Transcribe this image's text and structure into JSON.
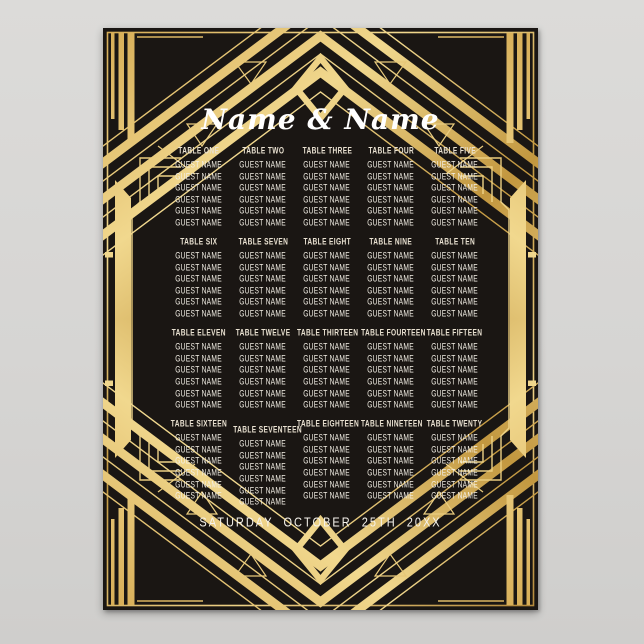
{
  "poster": {
    "title": "Name & Name",
    "date_line": "SATURDAY OCTOBER 25TH 20XX",
    "style": "art-deco-gatsby-seating-chart",
    "theme_colors": {
      "poster_black": "#1a1613",
      "gold_light": "#f1d88e",
      "gold_mid": "#d6ac55",
      "gold_deep": "#b3883a",
      "header_text": "#e9e1d1",
      "guest_text": "#f3efe5",
      "title_text": "#ffffff",
      "backdrop_gray": "#d6d5d3"
    },
    "guests_per_table": 6,
    "rows": [
      {
        "tables": [
          {
            "label": "TABLE ONE",
            "guests": [
              "GUEST NAME",
              "GUEST NAME",
              "GUEST NAME",
              "GUEST NAME",
              "GUEST NAME",
              "GUEST NAME"
            ]
          },
          {
            "label": "TABLE TWO",
            "guests": [
              "GUEST NAME",
              "GUEST NAME",
              "GUEST NAME",
              "GUEST NAME",
              "GUEST NAME",
              "GUEST NAME"
            ]
          },
          {
            "label": "TABLE THREE",
            "guests": [
              "GUEST NAME",
              "GUEST NAME",
              "GUEST NAME",
              "GUEST NAME",
              "GUEST NAME",
              "GUEST NAME"
            ]
          },
          {
            "label": "TABLE FOUR",
            "guests": [
              "GUEST NAME",
              "GUEST NAME",
              "GUEST NAME",
              "GUEST NAME",
              "GUEST NAME",
              "GUEST NAME"
            ]
          },
          {
            "label": "TABLE FIVE",
            "guests": [
              "GUEST NAME",
              "GUEST NAME",
              "GUEST NAME",
              "GUEST NAME",
              "GUEST NAME",
              "GUEST NAME"
            ]
          }
        ]
      },
      {
        "tables": [
          {
            "label": "TABLE SIX",
            "guests": [
              "GUEST NAME",
              "GUEST NAME",
              "GUEST NAME",
              "GUEST NAME",
              "GUEST NAME",
              "GUEST NAME"
            ]
          },
          {
            "label": "TABLE SEVEN",
            "guests": [
              "GUEST NAME",
              "GUEST NAME",
              "GUEST NAME",
              "GUEST NAME",
              "GUEST NAME",
              "GUEST NAME"
            ]
          },
          {
            "label": "TABLE EIGHT",
            "guests": [
              "GUEST NAME",
              "GUEST NAME",
              "GUEST NAME",
              "GUEST NAME",
              "GUEST NAME",
              "GUEST NAME"
            ]
          },
          {
            "label": "TABLE NINE",
            "guests": [
              "GUEST NAME",
              "GUEST NAME",
              "GUEST NAME",
              "GUEST NAME",
              "GUEST NAME",
              "GUEST NAME"
            ]
          },
          {
            "label": "TABLE TEN",
            "guests": [
              "GUEST NAME",
              "GUEST NAME",
              "GUEST NAME",
              "GUEST NAME",
              "GUEST NAME",
              "GUEST NAME"
            ]
          }
        ]
      },
      {
        "tables": [
          {
            "label": "TABLE ELEVEN",
            "guests": [
              "GUEST NAME",
              "GUEST NAME",
              "GUEST NAME",
              "GUEST NAME",
              "GUEST NAME",
              "GUEST NAME"
            ]
          },
          {
            "label": "TABLE TWELVE",
            "guests": [
              "GUEST NAME",
              "GUEST NAME",
              "GUEST NAME",
              "GUEST NAME",
              "GUEST NAME",
              "GUEST NAME"
            ]
          },
          {
            "label": "TABLE THIRTEEN",
            "guests": [
              "GUEST NAME",
              "GUEST NAME",
              "GUEST NAME",
              "GUEST NAME",
              "GUEST NAME",
              "GUEST NAME"
            ]
          },
          {
            "label": "TABLE FOURTEEN",
            "guests": [
              "GUEST NAME",
              "GUEST NAME",
              "GUEST NAME",
              "GUEST NAME",
              "GUEST NAME",
              "GUEST NAME"
            ]
          },
          {
            "label": "TABLE FIFTEEN",
            "guests": [
              "GUEST NAME",
              "GUEST NAME",
              "GUEST NAME",
              "GUEST NAME",
              "GUEST NAME",
              "GUEST NAME"
            ]
          }
        ]
      },
      {
        "tables": [
          {
            "label": "TABLE SIXTEEN",
            "guests": [
              "GUEST NAME",
              "GUEST NAME",
              "GUEST NAME",
              "GUEST NAME",
              "GUEST NAME",
              "GUEST NAME"
            ]
          },
          {
            "label": "TABLE SEVENTEEN",
            "guests": [
              "GUEST NAME",
              "GUEST NAME",
              "GUEST NAME",
              "GUEST NAME",
              "GUEST NAME",
              "GUEST NAME"
            ]
          },
          {
            "label": "TABLE EIGHTEEN",
            "guests": [
              "GUEST NAME",
              "GUEST NAME",
              "GUEST NAME",
              "GUEST NAME",
              "GUEST NAME",
              "GUEST NAME"
            ]
          },
          {
            "label": "TABLE NINETEEN",
            "guests": [
              "GUEST NAME",
              "GUEST NAME",
              "GUEST NAME",
              "GUEST NAME",
              "GUEST NAME",
              "GUEST NAME"
            ]
          },
          {
            "label": "TABLE TWENTY",
            "guests": [
              "GUEST NAME",
              "GUEST NAME",
              "GUEST NAME",
              "GUEST NAME",
              "GUEST NAME",
              "GUEST NAME"
            ]
          }
        ]
      }
    ]
  }
}
